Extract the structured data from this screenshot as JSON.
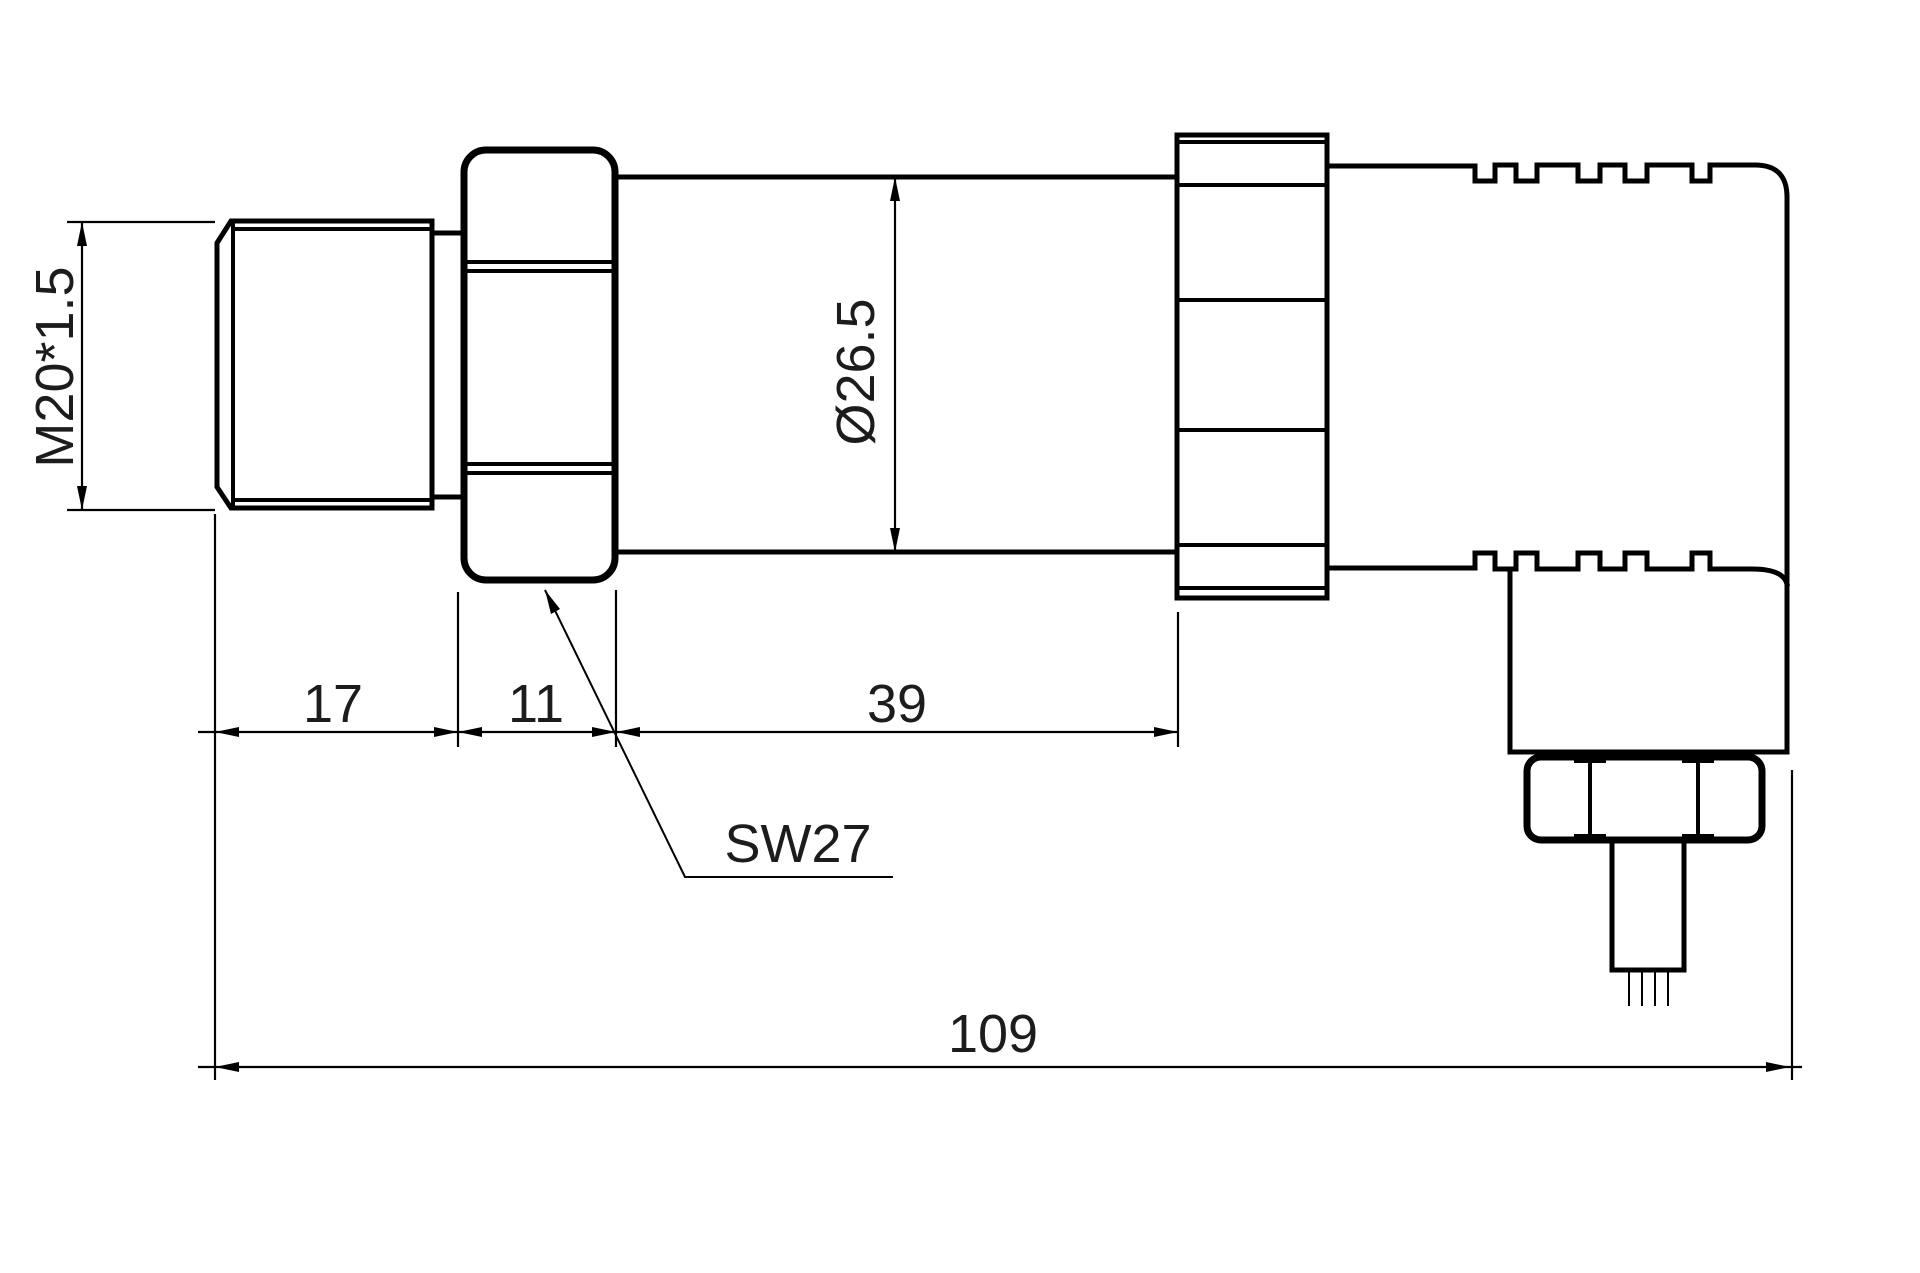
{
  "drawing": {
    "labels": {
      "thread_spec": "M20*1.5",
      "body_diameter": "Ø26.5",
      "thread_length": "17",
      "hex_length": "11",
      "body_length": "39",
      "wrench_size": "SW27",
      "overall_length": "109"
    },
    "colors": {
      "line": "#000000",
      "background": "#ffffff",
      "text": "#1c1c1c"
    }
  }
}
